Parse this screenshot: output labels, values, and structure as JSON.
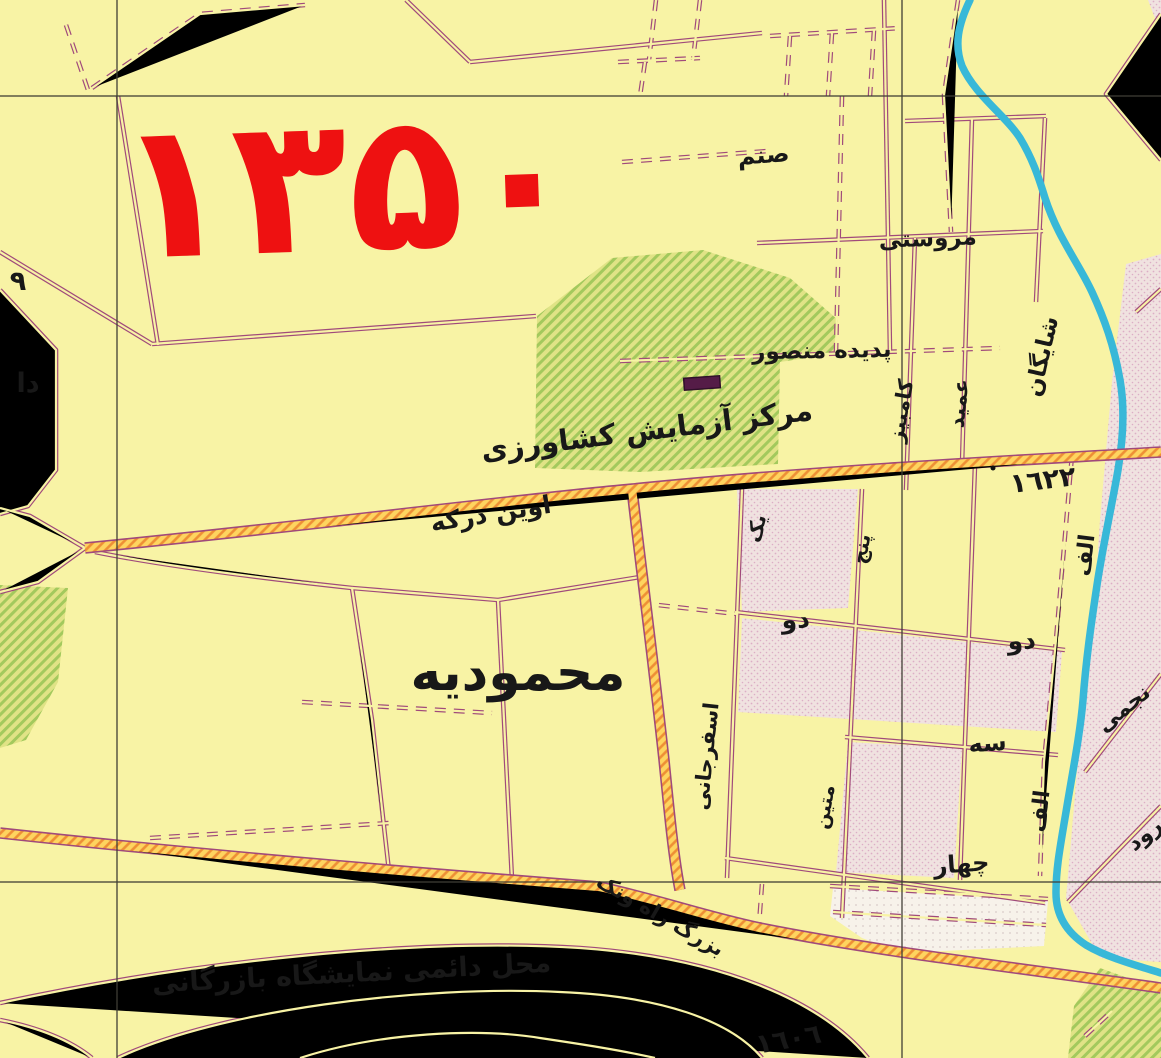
{
  "map": {
    "year_stamp": "۱۳۵۰",
    "colors": {
      "background": "#f8f3a5",
      "road_outline": "#a04a7b",
      "highway_fill": "#fed45f",
      "highway_hatch": "#ee8f35",
      "river": "#38b8d8",
      "green_area": "#e0e386",
      "green_hatch": "#a3c95d",
      "built_area": "#f0e2e0",
      "built_dots": "#dcaec6",
      "grid_line": "#3f3e35",
      "label_ink": "#181818",
      "year_red": "#ee1111"
    },
    "labels": [
      {
        "id": "year",
        "text": "۱۳۵۰",
        "x": 350,
        "y": 250,
        "rot": -2,
        "size": 190,
        "color": "#ee1111",
        "weight": "bold",
        "spacing": 4
      },
      {
        "id": "mahmoudieh",
        "text": "محمودیه",
        "x": 518,
        "y": 690,
        "rot": 0,
        "size": 52
      },
      {
        "id": "agri-center",
        "text": "مرکز آزمایش کشاورزی",
        "x": 648,
        "y": 440,
        "rot": -7,
        "size": 29
      },
      {
        "id": "evin-darakeh",
        "text": "اوین درکه",
        "x": 492,
        "y": 522,
        "rot": -9,
        "size": 25
      },
      {
        "id": "sanam",
        "text": "صنم",
        "x": 764,
        "y": 163,
        "rot": -4,
        "size": 24
      },
      {
        "id": "marvasti",
        "text": "مروستی",
        "x": 928,
        "y": 246,
        "rot": -2,
        "size": 23
      },
      {
        "id": "padideh-mansour",
        "text": "پدیده منصور",
        "x": 822,
        "y": 358,
        "rot": -1,
        "size": 23
      },
      {
        "id": "shayegan",
        "text": "شایگان",
        "x": 1049,
        "y": 358,
        "rot": -77,
        "size": 23
      },
      {
        "id": "amid",
        "text": "عمید",
        "x": 966,
        "y": 404,
        "rot": -84,
        "size": 21
      },
      {
        "id": "kambiz",
        "text": "کامبیز",
        "x": 908,
        "y": 412,
        "rot": -80,
        "size": 21
      },
      {
        "id": "elev-1622",
        "text": "١٦٢٢",
        "x": 1044,
        "y": 489,
        "rot": -7,
        "size": 27
      },
      {
        "id": "do-1",
        "text": "دو",
        "x": 796,
        "y": 628,
        "rot": -3,
        "size": 25
      },
      {
        "id": "do-2",
        "text": "دو",
        "x": 1022,
        "y": 649,
        "rot": -3,
        "size": 25
      },
      {
        "id": "seh",
        "text": "سه",
        "x": 988,
        "y": 751,
        "rot": -4,
        "size": 24
      },
      {
        "id": "chahar",
        "text": "چهار",
        "x": 962,
        "y": 872,
        "rot": -4,
        "size": 24
      },
      {
        "id": "alef-1",
        "text": "الف",
        "x": 1092,
        "y": 556,
        "rot": -83,
        "size": 22
      },
      {
        "id": "alef-2",
        "text": "الف",
        "x": 1047,
        "y": 812,
        "rot": -83,
        "size": 22
      },
      {
        "id": "esfarjani",
        "text": "اسفرجانی",
        "x": 713,
        "y": 757,
        "rot": -84,
        "size": 21
      },
      {
        "id": "matin",
        "text": "متین",
        "x": 831,
        "y": 808,
        "rot": -80,
        "size": 19
      },
      {
        "id": "yek",
        "text": "یک",
        "x": 763,
        "y": 530,
        "rot": -76,
        "size": 20
      },
      {
        "id": "panj",
        "text": "پنج",
        "x": 868,
        "y": 550,
        "rot": -80,
        "size": 20
      },
      {
        "id": "najmi",
        "text": "نجمی",
        "x": 1128,
        "y": 714,
        "rot": -39,
        "size": 22
      },
      {
        "id": "rood",
        "text": "رود",
        "x": 1149,
        "y": 840,
        "rot": -39,
        "size": 22
      },
      {
        "id": "vanak-hwy",
        "text": "بزرگ راه ونک",
        "x": 657,
        "y": 921,
        "rot": 30,
        "size": 21
      },
      {
        "id": "expo",
        "text": "محل دائمی نمایشگاه بازرگانی",
        "x": 352,
        "y": 982,
        "rot": -3,
        "size": 27
      },
      {
        "id": "elev-1606",
        "text": "١٦٠٦",
        "x": 790,
        "y": 1048,
        "rot": -10,
        "size": 27
      },
      {
        "id": "nine",
        "text": "٩",
        "x": 18,
        "y": 290,
        "rot": 0,
        "size": 27
      },
      {
        "id": "da",
        "text": "دا",
        "x": 28,
        "y": 392,
        "rot": 0,
        "size": 27
      }
    ]
  }
}
